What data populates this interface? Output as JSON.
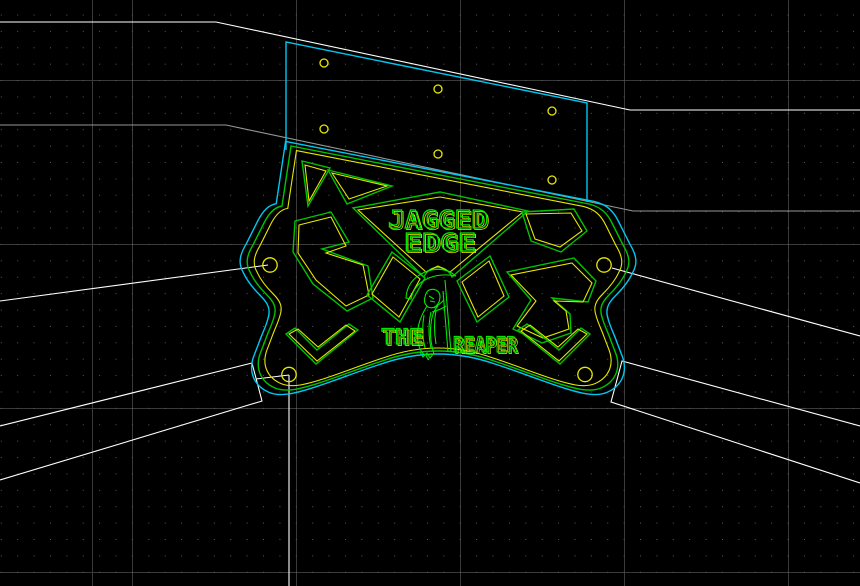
{
  "app": {
    "name": "cad-cam-drawing-view",
    "description": "CNC part layout over chassis construction lines"
  },
  "palette": {
    "background": "#000000",
    "grid_dot": "#5c5c5c",
    "grid_major": "#3a3a3a",
    "geometry_green": "#00c400",
    "engraving_green": "#00e800",
    "offset_yellow": "#e8e800",
    "toolpath_cyan": "#00c8f0",
    "construction_white": "#ffffff",
    "construction_gray": "#969696",
    "hole_yellow": "#e8e800"
  },
  "engravings": {
    "line1": "JAGGED",
    "line2": "EDGE",
    "line3": "THE",
    "line4": "REAPER"
  },
  "entities": {
    "part_mounting_holes": 4,
    "panel_rivet_holes": 6,
    "pocket_cutouts": 12
  }
}
